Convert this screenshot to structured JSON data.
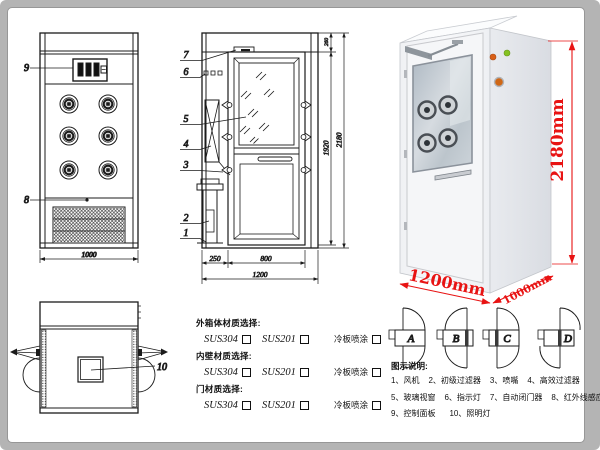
{
  "colors": {
    "dim_red": "#e81313",
    "line_ink": "#1b1b1b",
    "frame_gray": "#b4b4b4"
  },
  "front_view": {
    "callout_9": "9",
    "callout_8": "8",
    "dim_width": "1000"
  },
  "section_view": {
    "callouts": [
      "7",
      "6",
      "5",
      "4",
      "3",
      "2",
      "1"
    ],
    "dim_left_bay": "250",
    "dim_door": "800",
    "dim_total_width": "1200",
    "dim_top": "260",
    "dim_door_height": "1920",
    "dim_height": "2180"
  },
  "top_view": {
    "callout_10": "10"
  },
  "photo": {
    "dim_height": "2180mm",
    "dim_width": "1200mm",
    "dim_depth": "1000mm"
  },
  "door_options": {
    "a": "A",
    "b": "B",
    "c": "C",
    "d": "D"
  },
  "materials": {
    "sections": [
      {
        "title": "外箱体材质选择:",
        "opt1": "SUS304",
        "opt2": "SUS201",
        "opt3": "冷板喷涂"
      },
      {
        "title": "内壁材质选择:",
        "opt1": "SUS304",
        "opt2": "SUS201",
        "opt3": "冷板喷涂"
      },
      {
        "title": "门材质选择:",
        "opt1": "SUS304",
        "opt2": "SUS201",
        "opt3": "冷板喷涂"
      }
    ]
  },
  "legend": {
    "title": "图示说明:",
    "items": [
      "1、风机",
      "2、初级过滤器",
      "3、喷嘴",
      "4、高效过滤器",
      "5、玻璃视窗",
      "6、指示灯",
      "7、自动闭门器",
      "8、红外线感应器",
      "9、控制面板",
      "10、照明灯"
    ]
  }
}
